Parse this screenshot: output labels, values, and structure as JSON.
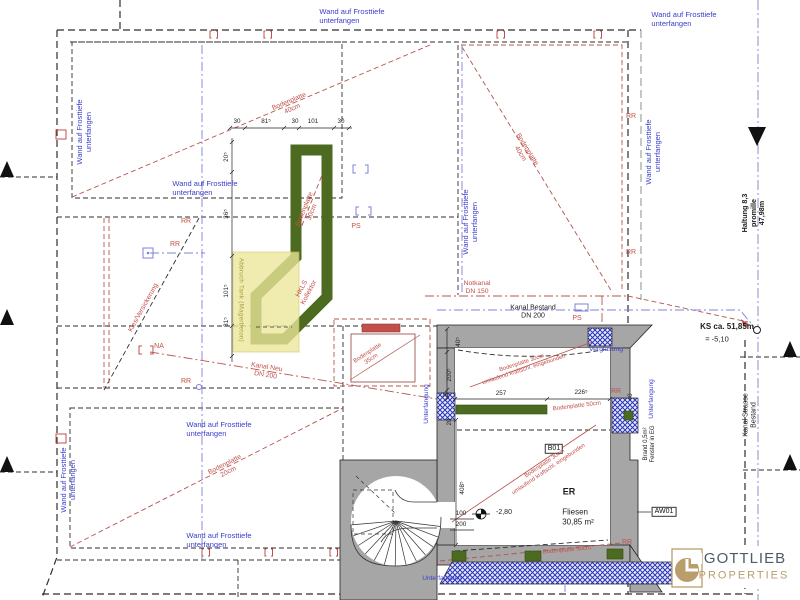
{
  "texts": {
    "wand": "Wand auf Frosttiefe\nunterfangen",
    "unterfangung": "Unterfangung",
    "verglasung": "Verglasung",
    "kanal_bestand": "Kanal Bestand\nDN 200",
    "kanal_neu": "Kanal Neu\nDN 200",
    "notkanal": "Notkanal\nDN 150",
    "kies": "Kies/Versickerung",
    "ks": "KS ca. 51,85m",
    "ks2": "= -5,10",
    "haltung": "Haltung 8,3 promille\n47,98m",
    "kanal_strasse": "Kanal Strasse Bestand",
    "er": "ER",
    "er_sub": "Fliesen\n30,85 m²",
    "b01": "B01",
    "aw01": "AW01",
    "brand": "Brand 0,5m²\nFenster in EG",
    "level": "-2,80",
    "bp40": "Bodenplatte\n40cm",
    "bp30": "Bodenplatte\n30cm",
    "bp35": "Bodenplatte\n35cm",
    "bp20": "Bodenplatte\n20cm",
    "bp30u": "Bodenplatte 30cm\numlaufend kraftschl. eingebunden",
    "bp50": "Bodenplatte 50cm",
    "hkls": "HKLS\nKollektor",
    "abbruch": "Abbruch Tank (Magerbeton)",
    "rr": "RR",
    "ps": "PS",
    "na": "NA"
  },
  "dims": {
    "d100": "100",
    "d200": "200",
    "t30": "30",
    "t815": "81⁵",
    "t101": "101",
    "t205": "20⁵",
    "t365": "36⁵",
    "t1015": "101⁵",
    "t257": "257",
    "t2265": "226⁵",
    "t405": "40⁵",
    "t2005": "200⁵",
    "t70": "70",
    "t4085": "408⁵",
    "t40": "40",
    "t20": "20"
  },
  "logo": {
    "name": "GOTTLIEB",
    "sub": "PROPERTIES"
  },
  "colors": {
    "blue_text": "#3a3ec9",
    "red_line": "#b5544d",
    "violet_line": "#8080d8",
    "wall_gray": "#a6a6a6",
    "green_wall": "#4d6b20",
    "tank_yellow": "#ece79a",
    "hatch_blue": "#2b35b5",
    "logo_tan": "#b99d6b",
    "logo_gray": "#4e5a66"
  }
}
